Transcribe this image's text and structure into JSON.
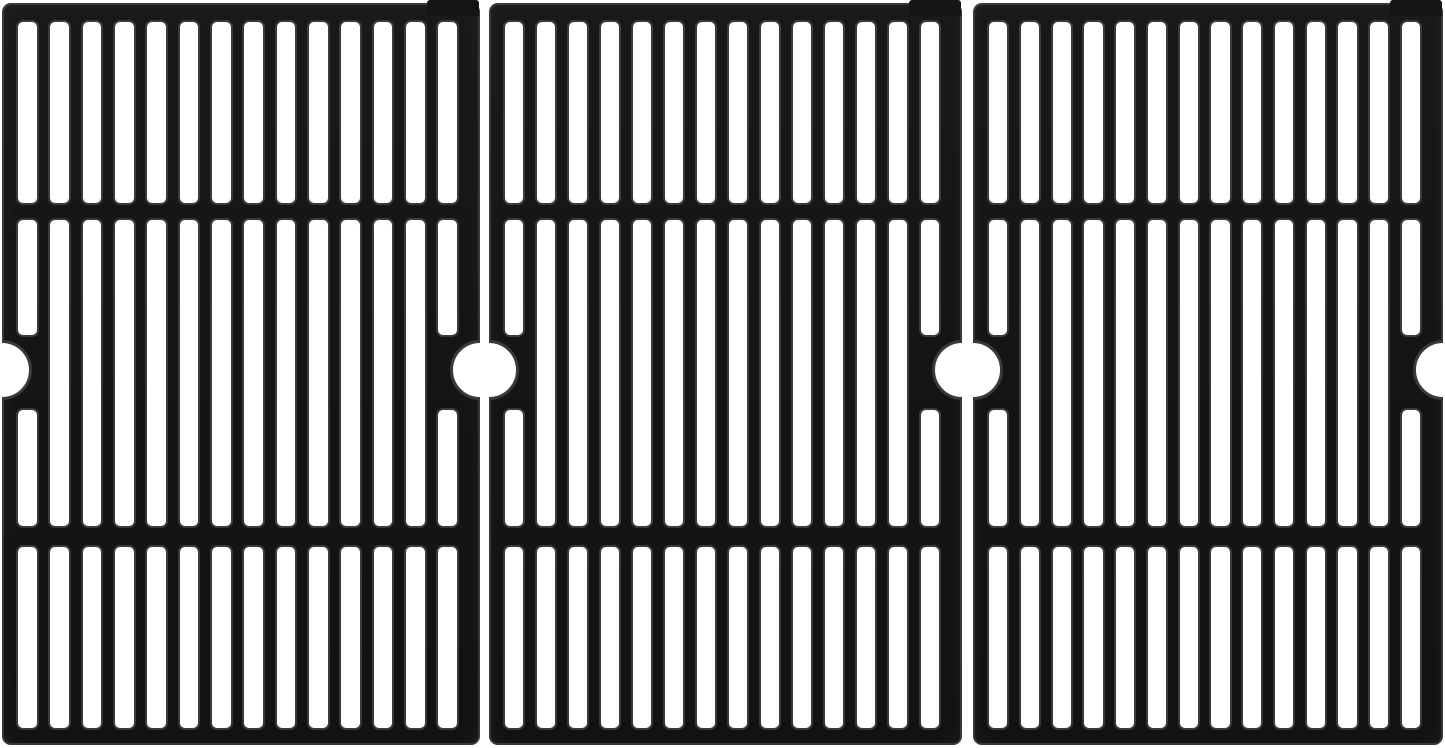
{
  "image_description": "Product photo: set of three matte black cast iron grill cooking grate panels standing side by side on a plain white background",
  "scene": {
    "background_color": "#ffffff",
    "panel_count": 3,
    "panels": [
      {
        "name": "grate-panel-left"
      },
      {
        "name": "grate-panel-center"
      },
      {
        "name": "grate-panel-right"
      }
    ],
    "panel_structure": {
      "columns_of_slots": 14,
      "slot_rows": [
        "top",
        "middle",
        "bottom"
      ],
      "side_notches_per_panel": 2,
      "notch_description": "semicircular cutout at mid-height of left and right edges",
      "edge_columns_note": "first and last columns have middle slot split above and below the notch",
      "material": "cast iron, matte enamel finish",
      "iron_color": "#151515",
      "rim_highlight_color": "#3a3a3a",
      "slot_color": "#ffffff"
    }
  }
}
